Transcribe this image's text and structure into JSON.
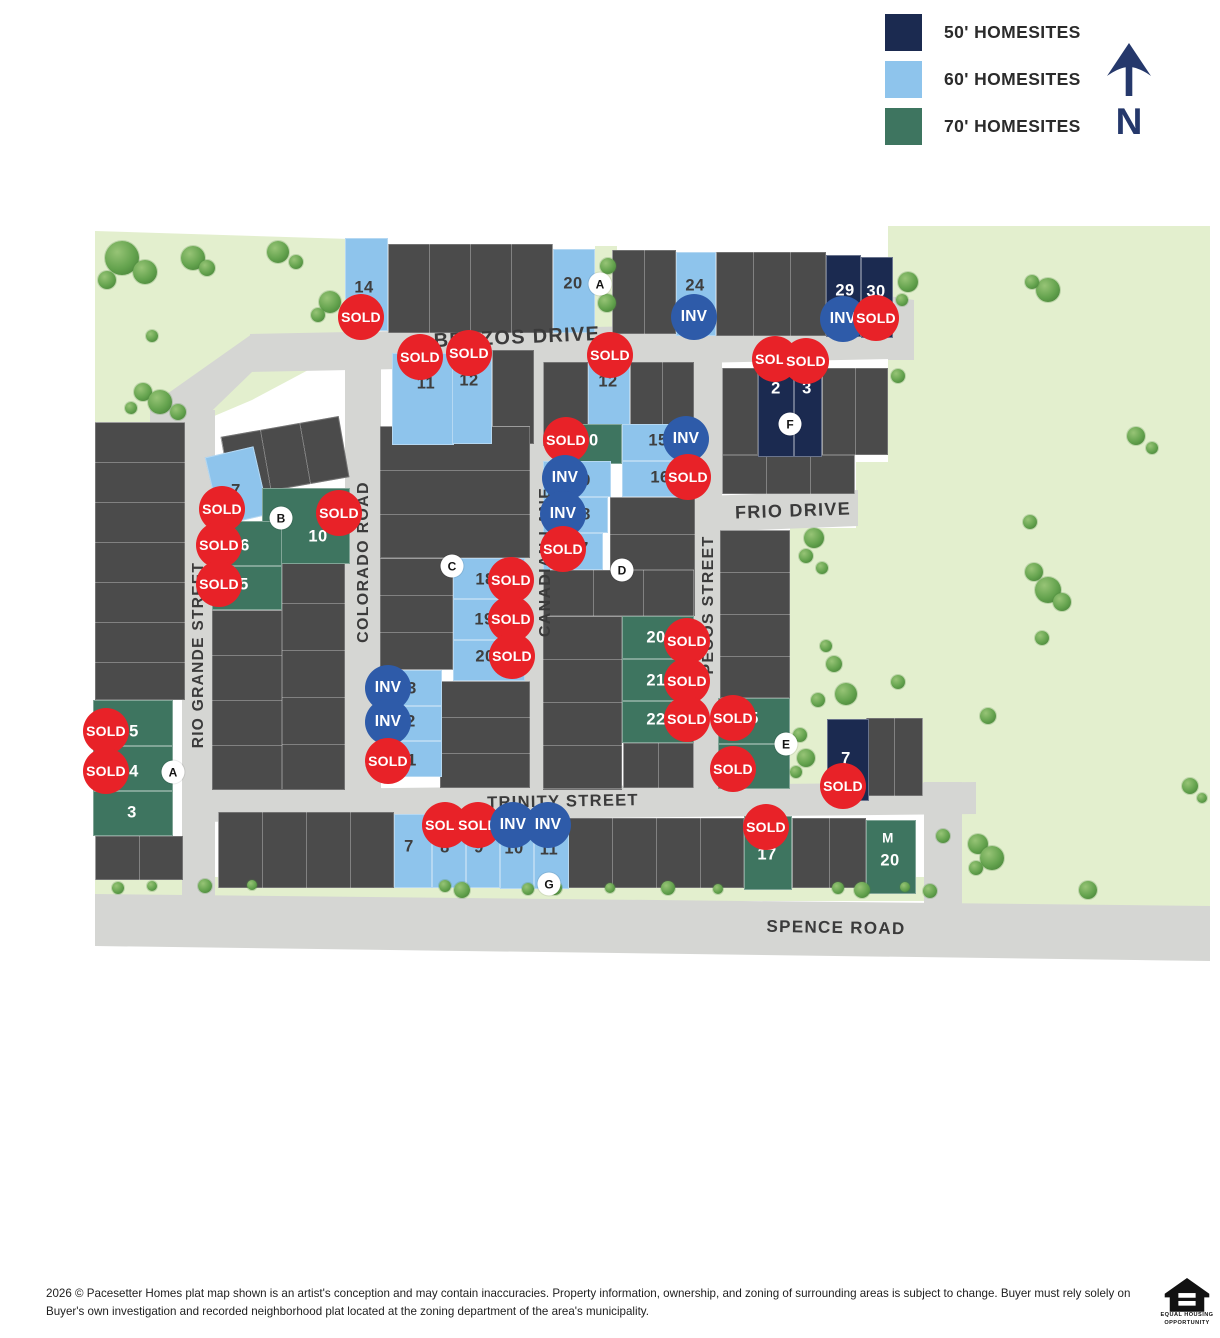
{
  "legend": {
    "items": [
      {
        "label": "50' HOMESITES",
        "color": "#1b2a50"
      },
      {
        "label": "60' HOMESITES",
        "color": "#8ec4ec"
      },
      {
        "label": "70' HOMESITES",
        "color": "#3e7560"
      }
    ]
  },
  "compass": {
    "label": "N"
  },
  "badges": {
    "sold": "SOLD",
    "inv": "INV"
  },
  "streets": {
    "brazos": "BRAZOS DRIVE",
    "frio": "FRIO DRIVE",
    "trinity": "TRINITY STREET",
    "spence": "SPENCE ROAD",
    "colorado": "COLORADO ROAD",
    "canadian": "CANADIAN LANE",
    "pecos": "PECOS STREET",
    "rio_grande": "RIO GRANDE STREET"
  },
  "map": {
    "colors": {
      "road": "#d5d6d3",
      "green_space": "#e3efce",
      "lot": "#4b4b4b",
      "homesite_50": "#1b2a50",
      "homesite_60": "#8ec4ec",
      "homesite_70": "#3e7560",
      "sold": "#e82228",
      "inv": "#2e5ba9"
    },
    "lots": [
      {
        "label": "14",
        "type": "60",
        "x": 345,
        "y": 238,
        "w": 43,
        "h": 93,
        "nx": 364,
        "ny": 288,
        "status": "sold",
        "bx": 361,
        "by": 317
      },
      {
        "label": "20",
        "type": "60",
        "x": 553,
        "y": 249,
        "w": 42,
        "h": 84,
        "nx": 573,
        "ny": 284
      },
      {
        "label": "24",
        "type": "60",
        "x": 676,
        "y": 252,
        "w": 40,
        "h": 84,
        "nx": 695,
        "ny": 286,
        "status": "inv",
        "bx": 694,
        "by": 317
      },
      {
        "label": "29",
        "type": "50",
        "x": 826,
        "y": 255,
        "w": 35,
        "h": 82,
        "nx": 845,
        "ny": 291,
        "status": "inv",
        "bx": 843,
        "by": 319
      },
      {
        "label": "30",
        "type": "50",
        "x": 861,
        "y": 257,
        "w": 32,
        "h": 81,
        "nx": 876,
        "ny": 292,
        "status": "sold",
        "bx": 876,
        "by": 318
      },
      {
        "label": "11",
        "type": "60",
        "x": 392,
        "y": 353,
        "w": 62,
        "h": 92,
        "nx": 426,
        "ny": 384,
        "status": "sold",
        "bx": 420,
        "by": 357
      },
      {
        "label": "12",
        "type": "60",
        "x": 452,
        "y": 349,
        "w": 40,
        "h": 95,
        "nx": 469,
        "ny": 381,
        "status": "sold",
        "bx": 469,
        "by": 353
      },
      {
        "label": "12",
        "type": "60",
        "x": 588,
        "y": 352,
        "w": 42,
        "h": 93,
        "nx": 608,
        "ny": 382,
        "status": "sold",
        "bx": 610,
        "by": 355
      },
      {
        "label": "2",
        "type": "50",
        "x": 758,
        "y": 368,
        "w": 36,
        "h": 89,
        "nx": 776,
        "ny": 389,
        "status": "sold",
        "bx": 775,
        "by": 359
      },
      {
        "label": "3",
        "type": "50",
        "x": 794,
        "y": 368,
        "w": 28,
        "h": 89,
        "nx": 807,
        "ny": 389,
        "status": "sold",
        "bx": 806,
        "by": 361
      },
      {
        "label": "10",
        "type": "70",
        "x": 558,
        "y": 424,
        "w": 64,
        "h": 40,
        "nx": 589,
        "ny": 441,
        "status": "sold",
        "bx": 566,
        "by": 440
      },
      {
        "label": "15",
        "type": "60",
        "x": 622,
        "y": 424,
        "w": 55,
        "h": 37,
        "nx": 658,
        "ny": 441,
        "status": "inv",
        "bx": 686,
        "by": 439
      },
      {
        "label": "16",
        "type": "60",
        "x": 622,
        "y": 461,
        "w": 55,
        "h": 36,
        "nx": 660,
        "ny": 478,
        "status": "sold",
        "bx": 688,
        "by": 477
      },
      {
        "label": "9",
        "type": "60",
        "x": 543,
        "y": 461,
        "w": 68,
        "h": 36,
        "nx": 586,
        "ny": 481,
        "status": "inv",
        "bx": 565,
        "by": 478
      },
      {
        "label": "8",
        "type": "60",
        "x": 543,
        "y": 497,
        "w": 65,
        "h": 36,
        "nx": 586,
        "ny": 515,
        "status": "inv",
        "bx": 563,
        "by": 514
      },
      {
        "label": "7",
        "type": "60",
        "x": 543,
        "y": 533,
        "w": 60,
        "h": 37,
        "nx": 584,
        "ny": 549,
        "status": "sold",
        "bx": 563,
        "by": 549
      },
      {
        "label": "7",
        "type": "60",
        "x": 212,
        "y": 451,
        "w": 50,
        "h": 70,
        "rot": -13,
        "nx": 236,
        "ny": 491,
        "status": "sold",
        "bx": 222,
        "by": 509
      },
      {
        "label": "10",
        "type": "70",
        "x": 262,
        "y": 488,
        "w": 88,
        "h": 76,
        "nx": 318,
        "ny": 537,
        "status": "sold",
        "bx": 339,
        "by": 513
      },
      {
        "label": "6",
        "type": "70",
        "x": 212,
        "y": 521,
        "w": 70,
        "h": 45,
        "nx": 245,
        "ny": 546,
        "status": "sold",
        "bx": 219,
        "by": 545
      },
      {
        "label": "5",
        "type": "70",
        "x": 212,
        "y": 566,
        "w": 70,
        "h": 44,
        "nx": 244,
        "ny": 585,
        "status": "sold",
        "bx": 219,
        "by": 584
      },
      {
        "label": "18",
        "type": "60",
        "x": 453,
        "y": 558,
        "w": 72,
        "h": 41,
        "nx": 485,
        "ny": 580,
        "status": "sold",
        "bx": 511,
        "by": 580
      },
      {
        "label": "19",
        "type": "60",
        "x": 453,
        "y": 599,
        "w": 72,
        "h": 41,
        "nx": 484,
        "ny": 620,
        "status": "sold",
        "bx": 511,
        "by": 619
      },
      {
        "label": "20",
        "type": "60",
        "x": 453,
        "y": 640,
        "w": 72,
        "h": 41,
        "nx": 485,
        "ny": 657,
        "status": "sold",
        "bx": 512,
        "by": 656
      },
      {
        "label": "20",
        "type": "70",
        "x": 622,
        "y": 616,
        "w": 72,
        "h": 43,
        "nx": 656,
        "ny": 638,
        "status": "sold",
        "bx": 687,
        "by": 641
      },
      {
        "label": "21",
        "type": "70",
        "x": 622,
        "y": 659,
        "w": 72,
        "h": 42,
        "nx": 656,
        "ny": 681,
        "status": "sold",
        "bx": 687,
        "by": 681
      },
      {
        "label": "22",
        "type": "70",
        "x": 622,
        "y": 701,
        "w": 72,
        "h": 42,
        "nx": 656,
        "ny": 720,
        "status": "sold",
        "bx": 687,
        "by": 719
      },
      {
        "label": "5",
        "type": "70",
        "x": 718,
        "y": 698,
        "w": 72,
        "h": 46,
        "nx": 754,
        "ny": 719,
        "status": "sold",
        "bx": 733,
        "by": 718
      },
      {
        "label": "6",
        "type": "70",
        "x": 718,
        "y": 744,
        "w": 72,
        "h": 45,
        "nx": 752,
        "ny": 769,
        "status": "sold",
        "bx": 733,
        "by": 769
      },
      {
        "label": "7",
        "type": "50",
        "x": 827,
        "y": 719,
        "w": 42,
        "h": 82,
        "nx": 846,
        "ny": 759,
        "status": "sold",
        "bx": 843,
        "by": 786
      },
      {
        "label": "3",
        "type": "60",
        "x": 380,
        "y": 670,
        "w": 62,
        "h": 36,
        "nx": 412,
        "ny": 689,
        "status": "inv",
        "bx": 388,
        "by": 688
      },
      {
        "label": "2",
        "type": "60",
        "x": 380,
        "y": 706,
        "w": 62,
        "h": 35,
        "nx": 411,
        "ny": 722,
        "status": "inv",
        "bx": 388,
        "by": 722
      },
      {
        "label": "1",
        "type": "60",
        "x": 380,
        "y": 741,
        "w": 62,
        "h": 36,
        "nx": 412,
        "ny": 761,
        "status": "sold",
        "bx": 388,
        "by": 761
      },
      {
        "label": "5",
        "type": "70",
        "x": 93,
        "y": 700,
        "w": 80,
        "h": 46,
        "nx": 134,
        "ny": 732,
        "status": "sold",
        "bx": 106,
        "by": 731
      },
      {
        "label": "4",
        "type": "70",
        "x": 93,
        "y": 746,
        "w": 80,
        "h": 45,
        "nx": 134,
        "ny": 772,
        "status": "sold",
        "bx": 106,
        "by": 771
      },
      {
        "label": "3",
        "type": "70",
        "x": 93,
        "y": 791,
        "w": 80,
        "h": 45,
        "nx": 132,
        "ny": 813
      },
      {
        "label": "7",
        "type": "60",
        "x": 394,
        "y": 814,
        "w": 38,
        "h": 74,
        "nx": 409,
        "ny": 847
      },
      {
        "label": "8",
        "type": "60",
        "x": 432,
        "y": 815,
        "w": 34,
        "h": 73,
        "nx": 445,
        "ny": 848,
        "status": "sold",
        "bx": 445,
        "by": 825
      },
      {
        "label": "9",
        "type": "60",
        "x": 466,
        "y": 815,
        "w": 34,
        "h": 73,
        "nx": 479,
        "ny": 848,
        "status": "sold",
        "bx": 478,
        "by": 825
      },
      {
        "label": "10",
        "type": "60",
        "x": 500,
        "y": 816,
        "w": 34,
        "h": 73,
        "nx": 514,
        "ny": 849,
        "status": "inv",
        "bx": 513,
        "by": 825
      },
      {
        "label": "11",
        "type": "60",
        "x": 534,
        "y": 816,
        "w": 35,
        "h": 73,
        "nx": 549,
        "ny": 850,
        "status": "inv",
        "bx": 548,
        "by": 825
      },
      {
        "label": "17",
        "type": "70",
        "x": 744,
        "y": 816,
        "w": 48,
        "h": 74,
        "nx": 767,
        "ny": 855,
        "status": "sold",
        "bx": 766,
        "by": 827
      },
      {
        "label": "20",
        "type": "70",
        "x": 866,
        "y": 820,
        "w": 50,
        "h": 74,
        "nx": 890,
        "ny": 861,
        "label2": "M",
        "l2x": 888,
        "l2y": 838
      }
    ],
    "markers": [
      {
        "label": "A",
        "x": 600,
        "y": 284
      },
      {
        "label": "F",
        "x": 790,
        "y": 424
      },
      {
        "label": "B",
        "x": 281,
        "y": 518
      },
      {
        "label": "C",
        "x": 452,
        "y": 566
      },
      {
        "label": "D",
        "x": 622,
        "y": 570
      },
      {
        "label": "E",
        "x": 786,
        "y": 744
      },
      {
        "label": "A",
        "x": 173,
        "y": 772
      },
      {
        "label": "G",
        "x": 549,
        "y": 884
      }
    ],
    "gray_blocks": [
      [
        388,
        244,
        165,
        89,
        "v",
        41
      ],
      [
        612,
        250,
        64,
        84,
        "v",
        32
      ],
      [
        716,
        252,
        110,
        84,
        "v",
        37
      ],
      [
        492,
        350,
        42,
        94,
        "v",
        42
      ],
      [
        225,
        426,
        120,
        62,
        "v",
        40,
        -10
      ],
      [
        282,
        556,
        63,
        234,
        "h",
        47
      ],
      [
        212,
        610,
        70,
        180,
        "h",
        45
      ],
      [
        95,
        422,
        90,
        278,
        "h",
        40
      ],
      [
        95,
        836,
        88,
        44,
        "v",
        44
      ],
      [
        380,
        426,
        150,
        132,
        "h",
        44
      ],
      [
        380,
        558,
        73,
        112,
        "h",
        37
      ],
      [
        440,
        681,
        90,
        107,
        "h",
        36
      ],
      [
        543,
        362,
        45,
        84,
        "v",
        45
      ],
      [
        630,
        362,
        64,
        83,
        "v",
        32
      ],
      [
        543,
        570,
        152,
        46,
        "v",
        50
      ],
      [
        610,
        497,
        85,
        73,
        "h",
        37
      ],
      [
        543,
        616,
        79,
        174,
        "h",
        43
      ],
      [
        623,
        743,
        71,
        45,
        "v",
        35
      ],
      [
        722,
        368,
        36,
        87,
        "v",
        36
      ],
      [
        822,
        368,
        66,
        87,
        "v",
        33
      ],
      [
        722,
        455,
        133,
        39,
        "v",
        44
      ],
      [
        720,
        530,
        70,
        168,
        "h",
        42
      ],
      [
        866,
        718,
        57,
        78,
        "v",
        28
      ],
      [
        218,
        812,
        176,
        76,
        "v",
        44
      ],
      [
        568,
        818,
        176,
        70,
        "v",
        44
      ],
      [
        792,
        818,
        74,
        70,
        "v",
        37
      ],
      [
        677,
        424,
        18,
        73,
        "h",
        36
      ]
    ],
    "trees": [
      [
        122,
        258,
        17
      ],
      [
        145,
        272,
        12
      ],
      [
        107,
        280,
        9
      ],
      [
        193,
        258,
        12
      ],
      [
        207,
        268,
        8
      ],
      [
        278,
        252,
        11
      ],
      [
        296,
        262,
        7
      ],
      [
        330,
        302,
        11
      ],
      [
        318,
        315,
        7
      ],
      [
        152,
        336,
        6
      ],
      [
        143,
        392,
        9
      ],
      [
        160,
        402,
        12
      ],
      [
        178,
        412,
        8
      ],
      [
        131,
        408,
        6
      ],
      [
        608,
        266,
        8
      ],
      [
        607,
        303,
        9
      ],
      [
        908,
        282,
        10
      ],
      [
        902,
        300,
        6
      ],
      [
        1048,
        290,
        12
      ],
      [
        1032,
        282,
        7
      ],
      [
        898,
        376,
        7
      ],
      [
        1136,
        436,
        9
      ],
      [
        1152,
        448,
        6
      ],
      [
        1030,
        522,
        7
      ],
      [
        1034,
        572,
        9
      ],
      [
        1048,
        590,
        13
      ],
      [
        1062,
        602,
        9
      ],
      [
        1042,
        638,
        7
      ],
      [
        988,
        716,
        8
      ],
      [
        898,
        682,
        7
      ],
      [
        814,
        538,
        10
      ],
      [
        806,
        556,
        7
      ],
      [
        822,
        568,
        6
      ],
      [
        826,
        646,
        6
      ],
      [
        834,
        664,
        8
      ],
      [
        846,
        694,
        11
      ],
      [
        818,
        700,
        7
      ],
      [
        800,
        735,
        7
      ],
      [
        806,
        758,
        9
      ],
      [
        796,
        772,
        6
      ],
      [
        943,
        836,
        7
      ],
      [
        978,
        844,
        10
      ],
      [
        992,
        858,
        12
      ],
      [
        976,
        868,
        7
      ],
      [
        1088,
        890,
        9
      ],
      [
        1190,
        786,
        8
      ],
      [
        1202,
        798,
        5
      ],
      [
        118,
        888,
        6
      ],
      [
        152,
        886,
        5
      ],
      [
        205,
        886,
        7
      ],
      [
        252,
        885,
        5
      ],
      [
        445,
        886,
        6
      ],
      [
        462,
        890,
        8
      ],
      [
        528,
        889,
        6
      ],
      [
        555,
        888,
        7
      ],
      [
        610,
        888,
        5
      ],
      [
        668,
        888,
        7
      ],
      [
        718,
        889,
        5
      ],
      [
        838,
        888,
        6
      ],
      [
        862,
        890,
        8
      ],
      [
        905,
        887,
        5
      ],
      [
        930,
        891,
        7
      ]
    ]
  },
  "footer": {
    "lines": [
      "2026 © Pacesetter Homes plat map shown is an artist's conception and may contain inaccuracies. Property information, ownership, and zoning of surrounding areas is subject to change. Buyer must rely solely on",
      "Buyer's own investigation and recorded neighborhood plat located at the zoning department of the area's municipality."
    ]
  },
  "equal_housing": {
    "lines": [
      "EQUAL HOUSING",
      "OPPORTUNITY"
    ]
  }
}
